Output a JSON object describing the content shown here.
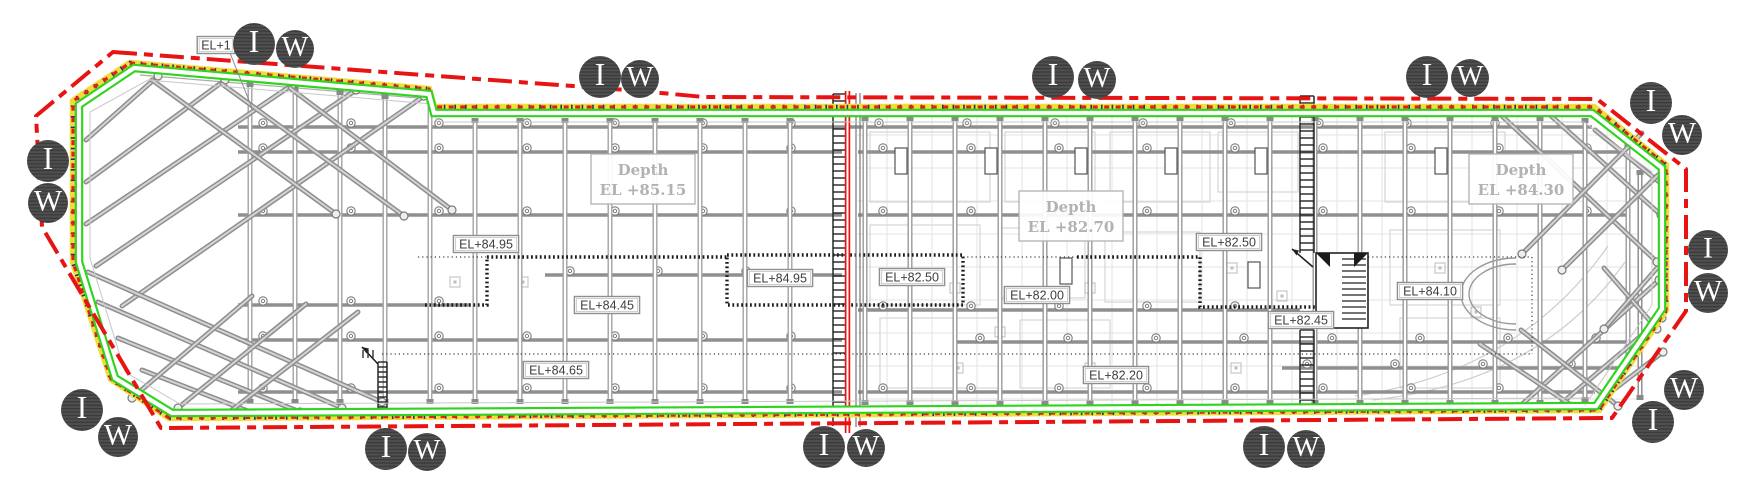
{
  "drawing": {
    "type": "excavation-shoring-site-plan",
    "width": 1760,
    "height": 500
  },
  "colors": {
    "boundary_red": "#e81414",
    "wall_green": "#2fd41f",
    "wall_yellow": "#f0dc3a",
    "dot_navy": "#26306e",
    "structure_gray": "#8f8f8f",
    "structure_light": "#c8c8c8",
    "grid_faint": "#e3e3e3",
    "dark": "#1c1c1c",
    "label_text": "#3e3e3e",
    "depth_text": "#b2b2b2",
    "marker_bg": "#4f4f4f",
    "marker_stripe": "#3a3a3a",
    "marker_letter": "#ffffff"
  },
  "depth_zones": [
    {
      "label": "Depth",
      "elevation": "EL +85.15",
      "x": 643,
      "y": 179
    },
    {
      "label": "Depth",
      "elevation": "EL +82.70",
      "x": 1071,
      "y": 216
    },
    {
      "label": "Depth",
      "elevation": "EL +84.30",
      "x": 1521,
      "y": 179
    }
  ],
  "elevation_labels": [
    {
      "text": "EL+1",
      "x": 216,
      "y": 45
    },
    {
      "text": "EL+84.95",
      "x": 486,
      "y": 244
    },
    {
      "text": "EL+84.45",
      "x": 607,
      "y": 305
    },
    {
      "text": "EL+84.65",
      "x": 556,
      "y": 370
    },
    {
      "text": "EL+84.95",
      "x": 780,
      "y": 278
    },
    {
      "text": "EL+82.50",
      "x": 912,
      "y": 277
    },
    {
      "text": "EL+82.00",
      "x": 1037,
      "y": 295
    },
    {
      "text": "EL+82.20",
      "x": 1116,
      "y": 375
    },
    {
      "text": "EL+82.50",
      "x": 1229,
      "y": 242
    },
    {
      "text": "EL+82.45",
      "x": 1301,
      "y": 320
    },
    {
      "text": "EL+84.10",
      "x": 1430,
      "y": 291
    }
  ],
  "markers": [
    {
      "letter": "I",
      "x": 254,
      "y": 44,
      "r": 21
    },
    {
      "letter": "W",
      "x": 295,
      "y": 49,
      "r": 19
    },
    {
      "letter": "I",
      "x": 600,
      "y": 77,
      "r": 21
    },
    {
      "letter": "W",
      "x": 640,
      "y": 79,
      "r": 19
    },
    {
      "letter": "I",
      "x": 1053,
      "y": 77,
      "r": 21
    },
    {
      "letter": "W",
      "x": 1097,
      "y": 80,
      "r": 19
    },
    {
      "letter": "I",
      "x": 1427,
      "y": 77,
      "r": 21
    },
    {
      "letter": "W",
      "x": 1470,
      "y": 78,
      "r": 19
    },
    {
      "letter": "I",
      "x": 1651,
      "y": 103,
      "r": 21
    },
    {
      "letter": "W",
      "x": 1682,
      "y": 135,
      "r": 20
    },
    {
      "letter": "I",
      "x": 48,
      "y": 161,
      "r": 21
    },
    {
      "letter": "W",
      "x": 48,
      "y": 203,
      "r": 20
    },
    {
      "letter": "I",
      "x": 1708,
      "y": 250,
      "r": 20
    },
    {
      "letter": "W",
      "x": 1708,
      "y": 293,
      "r": 20
    },
    {
      "letter": "I",
      "x": 82,
      "y": 410,
      "r": 21
    },
    {
      "letter": "W",
      "x": 118,
      "y": 437,
      "r": 20
    },
    {
      "letter": "I",
      "x": 386,
      "y": 449,
      "r": 21
    },
    {
      "letter": "W",
      "x": 427,
      "y": 452,
      "r": 19
    },
    {
      "letter": "I",
      "x": 824,
      "y": 447,
      "r": 21
    },
    {
      "letter": "W",
      "x": 866,
      "y": 448,
      "r": 19
    },
    {
      "letter": "I",
      "x": 1264,
      "y": 447,
      "r": 21
    },
    {
      "letter": "W",
      "x": 1306,
      "y": 449,
      "r": 19
    },
    {
      "letter": "W",
      "x": 1684,
      "y": 390,
      "r": 20
    },
    {
      "letter": "I",
      "x": 1653,
      "y": 422,
      "r": 21
    }
  ],
  "geometry": {
    "outer_red": "M113,52 L640,91 L704,97 L1597,99 L1686,169 L1686,311 L1612,418 L161,428 L42,227 L36,116 Z",
    "band_yellow": "M130,63 L429,89 L434,107 L1594,107 L1666,165 L1666,310 L1599,410 L169,418 L111,379 L73,262 L73,101 Z",
    "wall_green": "M134,68 L429,94 L434,113 L1592,113 L1662,168 L1662,309 L1596,406 L172,413 L115,378 L79,262 L79,105 Z",
    "inner_faint": "M148,80 L432,104 L437,122 L1584,122 L1652,172 L1652,305 L1590,398 L180,404 L125,372 L90,258 L90,112 Z",
    "divider": {
      "x": 847.5,
      "y1": 91,
      "y2": 433
    },
    "piles_left": [
      [
        250,
        84,
        402
      ],
      [
        295,
        88,
        402
      ],
      [
        340,
        92,
        402
      ],
      [
        385,
        96,
        402
      ],
      [
        430,
        100,
        402
      ],
      [
        475,
        120,
        402
      ],
      [
        520,
        120,
        402
      ],
      [
        565,
        120,
        402
      ],
      [
        610,
        120,
        402
      ],
      [
        655,
        120,
        402
      ],
      [
        700,
        120,
        402
      ],
      [
        745,
        120,
        402
      ],
      [
        790,
        120,
        402
      ]
    ],
    "piles_right": [
      [
        865,
        118,
        403
      ],
      [
        910,
        118,
        403
      ],
      [
        955,
        118,
        403
      ],
      [
        1000,
        118,
        403
      ],
      [
        1045,
        118,
        403
      ],
      [
        1090,
        118,
        403
      ],
      [
        1135,
        118,
        403
      ],
      [
        1180,
        118,
        403
      ],
      [
        1225,
        118,
        403
      ],
      [
        1270,
        118,
        403
      ],
      [
        1315,
        118,
        403
      ],
      [
        1360,
        118,
        403
      ],
      [
        1405,
        118,
        403
      ],
      [
        1450,
        118,
        403
      ],
      [
        1495,
        118,
        403
      ],
      [
        1540,
        118,
        403
      ],
      [
        1585,
        120,
        400
      ],
      [
        1628,
        145,
        360
      ]
    ],
    "beams": [
      [
        127,
        238,
        1592
      ],
      [
        152,
        238,
        842
      ],
      [
        152,
        858,
        1628
      ],
      [
        215,
        238,
        842
      ],
      [
        215,
        858,
        1628
      ],
      [
        275,
        545,
        842
      ],
      [
        305,
        238,
        470
      ],
      [
        310,
        858,
        1300
      ],
      [
        340,
        238,
        842
      ],
      [
        342,
        955,
        1628
      ],
      [
        368,
        1282,
        1628
      ],
      [
        392,
        238,
        842
      ],
      [
        392,
        858,
        1595
      ]
    ],
    "struts_main": [
      [
        86,
        140,
        158,
        76
      ],
      [
        86,
        182,
        225,
        80
      ],
      [
        86,
        224,
        292,
        85
      ],
      [
        96,
        266,
        356,
        90
      ],
      [
        122,
        306,
        424,
        96
      ],
      [
        88,
        272,
        382,
        402
      ],
      [
        98,
        302,
        342,
        408
      ],
      [
        118,
        338,
        300,
        412
      ],
      [
        142,
        370,
        258,
        415
      ],
      [
        1502,
        116,
        1657,
        262
      ],
      [
        1549,
        114,
        1661,
        215
      ],
      [
        1595,
        130,
        1663,
        185
      ],
      [
        1519,
        407,
        1659,
        280
      ],
      [
        1556,
        408,
        1662,
        318
      ],
      [
        1591,
        407,
        1663,
        352
      ],
      [
        1604,
        268,
        1657,
        329
      ]
    ],
    "struts_cross": [
      [
        152,
        80,
        336,
        214
      ],
      [
        222,
        84,
        404,
        216
      ],
      [
        290,
        88,
        452,
        210
      ],
      [
        252,
        296,
        132,
        398
      ],
      [
        306,
        304,
        178,
        408
      ],
      [
        358,
        312,
        228,
        413
      ],
      [
        1642,
        133,
        1522,
        254
      ],
      [
        1658,
        175,
        1562,
        270
      ],
      [
        1521,
        330,
        1618,
        406
      ],
      [
        1480,
        344,
        1574,
        407
      ],
      [
        1657,
        268,
        1604,
        329
      ]
    ],
    "pit_outlines": [
      "M425,305 L487,305 L487,257 L727,257",
      "M727,255 L963,255 L963,305 L727,305 L727,255",
      "M1077,257 L1200,257 L1200,307 L1316,307"
    ],
    "fine_dotted": [
      "M418,257 L487,257",
      "M963,257 L1077,257",
      "M1368,257 L1532,257",
      "M1532,257 L1532,354",
      "M382,354 L1532,354"
    ],
    "ladders": [
      {
        "x1": 833,
        "x2": 849,
        "y1": 94,
        "y2": 426,
        "step": 7
      },
      {
        "x1": 1300,
        "x2": 1314,
        "y1": 96,
        "y2": 253,
        "step": 7
      },
      {
        "x1": 1300,
        "x2": 1314,
        "y1": 330,
        "y2": 410,
        "step": 7
      },
      {
        "x1": 378,
        "x2": 387,
        "y1": 362,
        "y2": 418,
        "step": 5
      }
    ],
    "stair_box": {
      "x": 1316,
      "y": 253,
      "w": 52,
      "h": 75
    },
    "arrows": [
      [
        1313,
        267,
        1292,
        249
      ],
      [
        378,
        364,
        362,
        347
      ]
    ],
    "ramp_arcs": [
      "M1516,258 A55,36 0 0 0 1516,330",
      "M1516,264 A47,30 0 0 0 1516,324"
    ],
    "faint_curves": [
      "M1355,396 Q1520,372 1608,246",
      "M1373,400 Q1540,382 1625,262"
    ],
    "dark_rects": [
      [
        895,
        148
      ],
      [
        985,
        148
      ],
      [
        1075,
        148
      ],
      [
        1165,
        148
      ],
      [
        1255,
        148
      ],
      [
        1435,
        148
      ],
      [
        1060,
        258
      ],
      [
        1248,
        262
      ]
    ],
    "rooms": [
      [
        870,
        132,
        120,
        70
      ],
      [
        1005,
        132,
        90,
        70
      ],
      [
        1110,
        132,
        100,
        70
      ],
      [
        1218,
        132,
        80,
        60
      ],
      [
        1385,
        132,
        120,
        70
      ],
      [
        870,
        225,
        110,
        80
      ],
      [
        1000,
        228,
        85,
        70
      ],
      [
        1105,
        232,
        95,
        70
      ],
      [
        1390,
        230,
        110,
        75
      ],
      [
        880,
        318,
        120,
        70
      ],
      [
        1020,
        320,
        90,
        68
      ],
      [
        1400,
        318,
        100,
        70
      ]
    ],
    "small_squares": [
      [
        955,
        288
      ],
      [
        1000,
        332
      ],
      [
        1090,
        288
      ],
      [
        1232,
        268
      ],
      [
        1282,
        296
      ],
      [
        1440,
        268
      ],
      [
        1476,
        312
      ],
      [
        958,
        368
      ],
      [
        1090,
        368
      ],
      [
        1236,
        368
      ],
      [
        523,
        282
      ],
      [
        455,
        282
      ]
    ],
    "right_vertical_pair_x": 1640,
    "leader_el1": [
      230,
      53,
      252,
      108
    ]
  }
}
